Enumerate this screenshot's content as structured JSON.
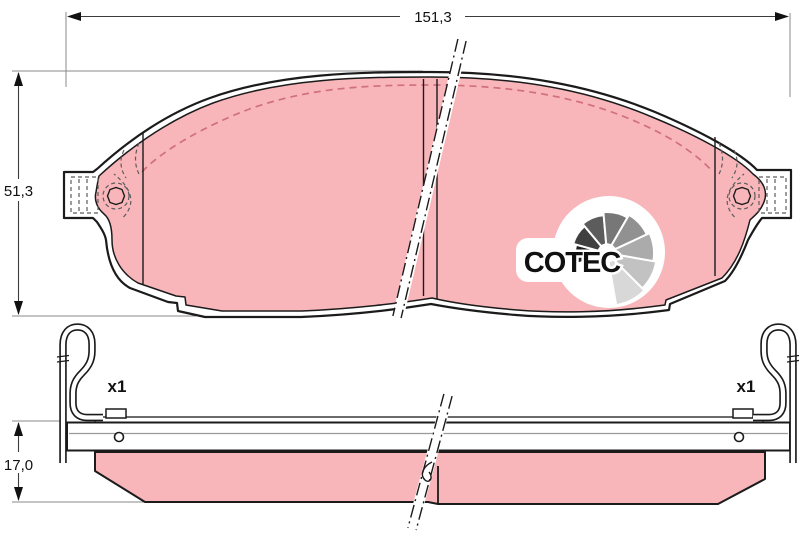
{
  "drawing": {
    "dimensions": {
      "width_label": "151,3",
      "height_label": "51,3",
      "thickness_label": "17,0"
    },
    "accessories": {
      "left_qty_label": "x1",
      "right_qty_label": "x1"
    },
    "logo": {
      "text": "COTEC"
    },
    "colors": {
      "friction_pink": "#f8b6ba",
      "chamfer_rose": "#d0707c",
      "line_black": "#1b1b1b",
      "fan_grays": [
        "#1e1e1e",
        "#404040",
        "#5c5c5c",
        "#777777",
        "#919191",
        "#ababab",
        "#c2c2c2",
        "#d8d8d8"
      ]
    }
  }
}
